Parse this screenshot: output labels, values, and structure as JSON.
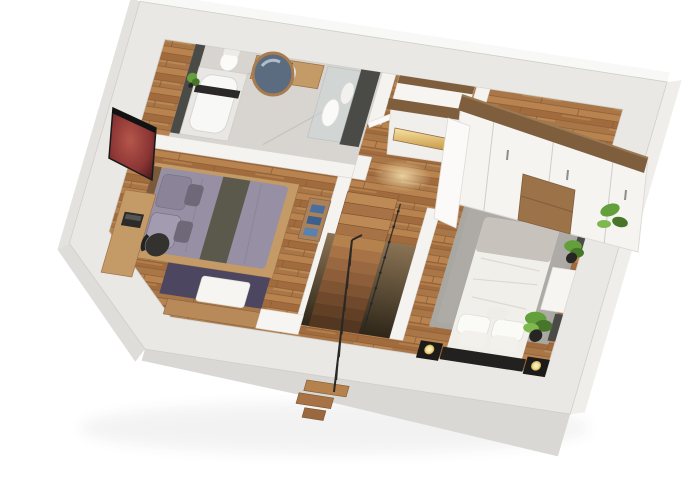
{
  "meta": {
    "title": "3D floor plan — upper storey cutaway",
    "view": "dollhouse three-quarter top view, white background"
  },
  "palette": {
    "background": "#ffffff",
    "wall_top": "#e9e8e5",
    "wall_inner": "#f4f3f0",
    "wall_face_bottom": "#d9d8d4",
    "wall_face_side": "#efeeeb",
    "wall_face_top": "#f8f8f6",
    "floor_wood": "#b07c4c",
    "bath_floor": "#d8d5d1",
    "dark_wall": "#4a4a47",
    "tub_white": "#f8f8f6",
    "vanity_wood": "#c49a66",
    "mirror_glass": "#5b6c80",
    "mirror_frame": "#a87c4e",
    "sink_white": "#ffffff",
    "bed_left_duvet": "#978fa4",
    "bed_left_stripe": "#5a594b",
    "pillow_purple": "#8b8498",
    "rug_left": "#4d4660",
    "desk_wood": "#c49a66",
    "chair_black": "#33322f",
    "shelf_wood": "#a9815a",
    "clothes_blue": "#4a6f9e",
    "white_furniture": "#f6f5f2",
    "rug_right": "#a9a7a2",
    "bedding_right": "#f1efe9",
    "blanket_right": "#c7c3bc",
    "headboard_right": "#23211f",
    "nightstand_black": "#1d1b1a",
    "lamp_glow": "#f5e097",
    "wardrobe_face": "#f5f4f1",
    "wardrobe_wood": "#7f5e3e",
    "drawer_wood": "#9c7248",
    "plant_green": "#63a03c",
    "plant_dark": "#47762a",
    "pot_black": "#262523",
    "stair_light": "#bd8a55",
    "stair_dark": "#a87247",
    "rail_black": "#2a2927",
    "tv_red": "#a03a33",
    "niche_glow": "#f4d58a",
    "light_pool": "#f6dfae"
  },
  "rooms": [
    {
      "name": "bathroom",
      "furniture": [
        "bathtub with deck tray",
        "vanity with round vessel sink",
        "round wood-framed mirror",
        "walk-in shower with towels",
        "toilet",
        "small potted plant",
        "dark accent walls",
        "marble floor"
      ]
    },
    {
      "name": "bedroom-left",
      "furniture": [
        "double bed with purple bedding and olive runner",
        "wall-mounted tv with galaxy image",
        "desk with laptop",
        "black office chair",
        "dark purple rug",
        "white storage bench",
        "open shelf with folded blue clothes",
        "low wood cabinets"
      ]
    },
    {
      "name": "hallway-landing",
      "furniture": [
        "white console with wood trim and illuminated niche",
        "winder staircase to lower floor",
        "black metal railing",
        "warm recessed floor lighting"
      ]
    },
    {
      "name": "bedroom-right",
      "furniture": [
        "double bed with white bedding and gray blanket",
        "black upholstered headboard",
        "black nightstands with sphere lamps",
        "large gray area rug",
        "built-in wardrobe with white doors and wood drawers",
        "open wardrobe door",
        "white side tables",
        "potted plants",
        "dark wall panels"
      ]
    }
  ]
}
